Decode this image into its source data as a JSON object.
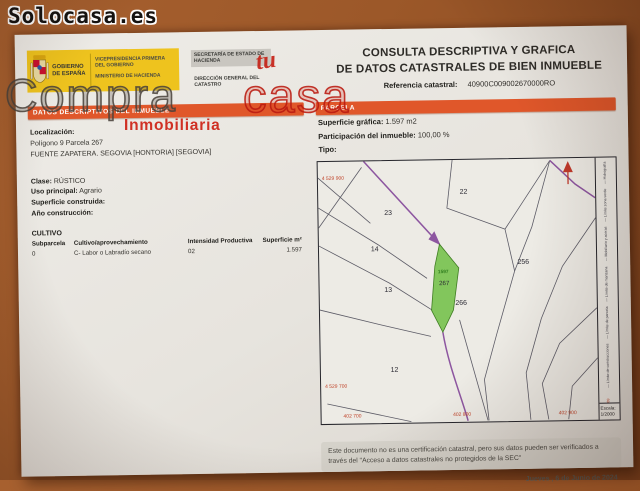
{
  "watermark": {
    "site": "Solocasa.es",
    "compra": "Compra",
    "tu": "tu",
    "casa": "casa",
    "inmobiliaria": "Inmobiliaria"
  },
  "header": {
    "gobierno": "GOBIERNO DE ESPAÑA",
    "vicepresidencia": "VICEPRESIDENCIA PRIMERA DEL GOBIERNO",
    "ministerio": "MINISTERIO DE HACIENDA",
    "secretaria": "SECRETARÍA DE ESTADO DE HACIENDA",
    "direccion": "DIRECCIÓN GENERAL DEL CATASTRO",
    "title_line1": "CONSULTA DESCRIPTIVA Y GRAFICA",
    "title_line2": "DE DATOS CATASTRALES DE BIEN INMUEBLE",
    "ref_label": "Referencia catastral:",
    "ref_value": "40900C009002670000RO"
  },
  "datos": {
    "section_title": "DATOS DESCRIPTIVOS DEL INMUEBLE",
    "localizacion_label": "Localización:",
    "localizacion_line1": "Polígono 9 Parcela 267",
    "localizacion_line2": "FUENTE ZAPATERA. SEGOVIA [HONTORIA] [SEGOVIA]",
    "clase_label": "Clase:",
    "clase_value": "RÚSTICO",
    "uso_label": "Uso principal:",
    "uso_value": "Agrario",
    "superficie_label": "Superficie construida:",
    "anio_label": "Año construcción:",
    "cultivo_title": "CULTIVO",
    "cultivo_table": {
      "headers": [
        "Subparcela",
        "Cultivo/aprovechamiento",
        "Intensidad Productiva",
        "Superficie m²"
      ],
      "rows": [
        [
          "0",
          "C- Labor o Labradío secano",
          "02",
          "1.597"
        ]
      ]
    }
  },
  "parcela": {
    "section_title": "PARCELA",
    "superficie_label": "Superficie gráfica:",
    "superficie_value": "1.597 m2",
    "participacion_label": "Participación del inmueble:",
    "participacion_value": "100,00 %",
    "tipo_label": "Tipo:",
    "map": {
      "labels": {
        "n22": "22",
        "n23": "23",
        "n14": "14",
        "n13": "13",
        "n12": "12",
        "n256": "256",
        "n266": "266",
        "n267": "267",
        "area": "1597"
      },
      "coords": {
        "top_left": "4 529 900",
        "bottom_left": "4 529 700",
        "b0": "402 700",
        "b1": "402 800",
        "b2": "402 900"
      },
      "legend": [
        "— Hidrografía",
        "— Límite zona verde",
        "--- Mobiliario y aceras",
        "— Límite de manzana",
        "— Límite de parcela",
        "— Límite de construcciones"
      ],
      "coord_note": "402.800 Coordenadas U.T.M. Huso 30 ETRS89",
      "escala_label": "Escala:",
      "escala_value": "1/2000",
      "highlight_color": "#6fbf44",
      "boundary_color": "#8d56a0",
      "coord_color": "#c0452b"
    }
  },
  "footer": {
    "note": "Este documento no es una certificación catastral, pero sus datos pueden ser verificados a través del \"Acceso a datos catastrales no protegidos de la SEC\"",
    "date": "Jueves , 6 de Junio de 2024"
  }
}
